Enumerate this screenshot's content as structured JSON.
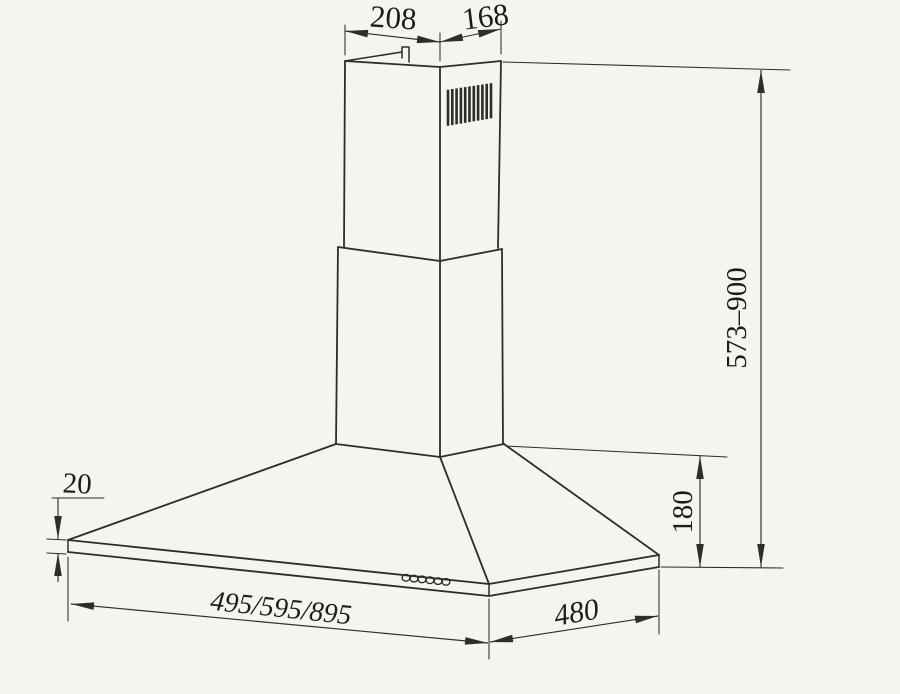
{
  "drawing": {
    "subject": "chimney-range-hood-technical-drawing",
    "dimensions": {
      "chimney_top_width": "208",
      "chimney_top_depth": "168",
      "chimney_height_range": "573–900",
      "hood_body_height": "180",
      "rim_thickness": "20",
      "hood_width_options": "495/595/895",
      "hood_depth": "480"
    }
  },
  "colors": {
    "paper": "#f6f4ee",
    "line": "#2f2d2a",
    "ink": "#1e1c1a"
  }
}
